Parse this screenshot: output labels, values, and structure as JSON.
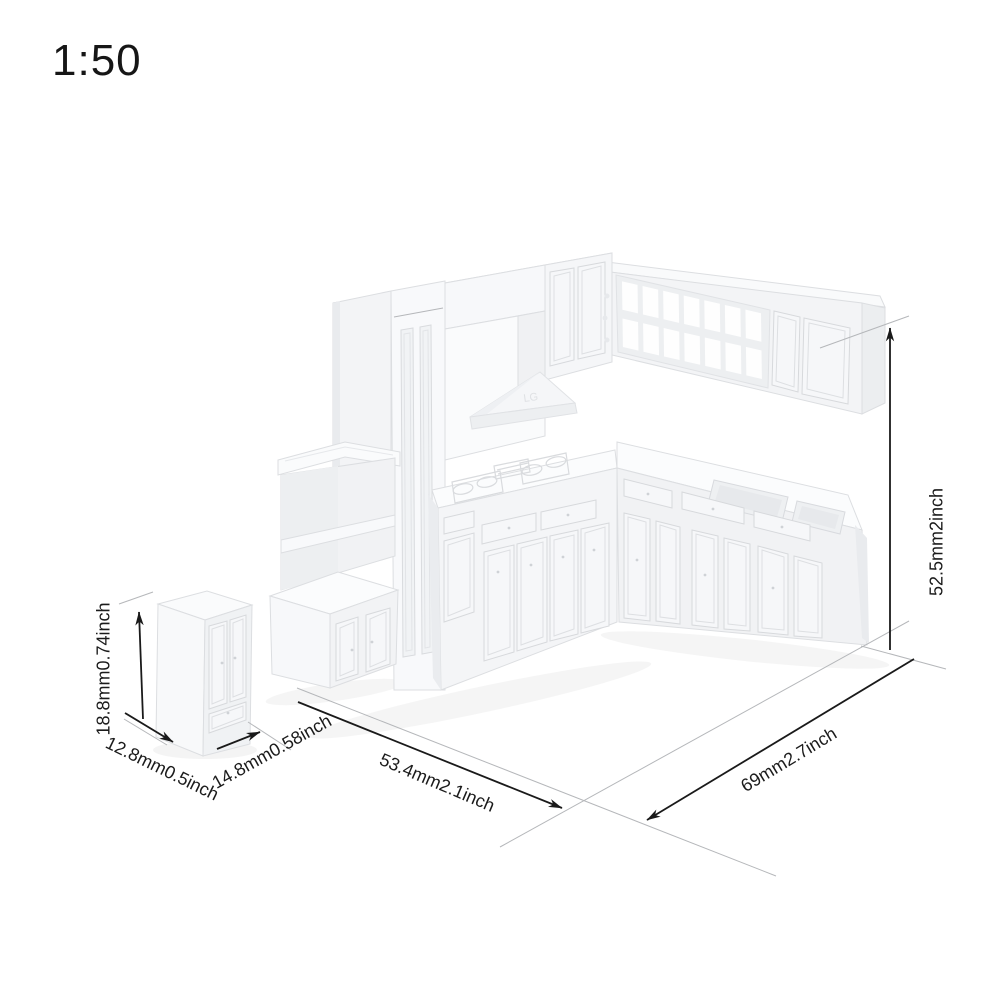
{
  "scale_label": "1:50",
  "model": {
    "name": "miniature white plastic kitchen cabinet set, 1:50 scale",
    "color_hex": "#f4f5f7",
    "hood_embossed_text": "LG"
  },
  "dimensions": {
    "small_cabinet_height": "18.8mm0.74inch",
    "small_cabinet_depth": "12.8mm0.5inch",
    "small_cabinet_width": "14.8mm0.58inch",
    "left_run_width": "53.4mm2.1inch",
    "right_run_width": "69mm2.7inch",
    "wall_height": "52.5mm2inch"
  },
  "colors": {
    "background": "#ffffff",
    "dimension_line": "#1a1a1a",
    "extension_line": "#b5b7ba",
    "annotation_text": "#1b1b1b"
  }
}
